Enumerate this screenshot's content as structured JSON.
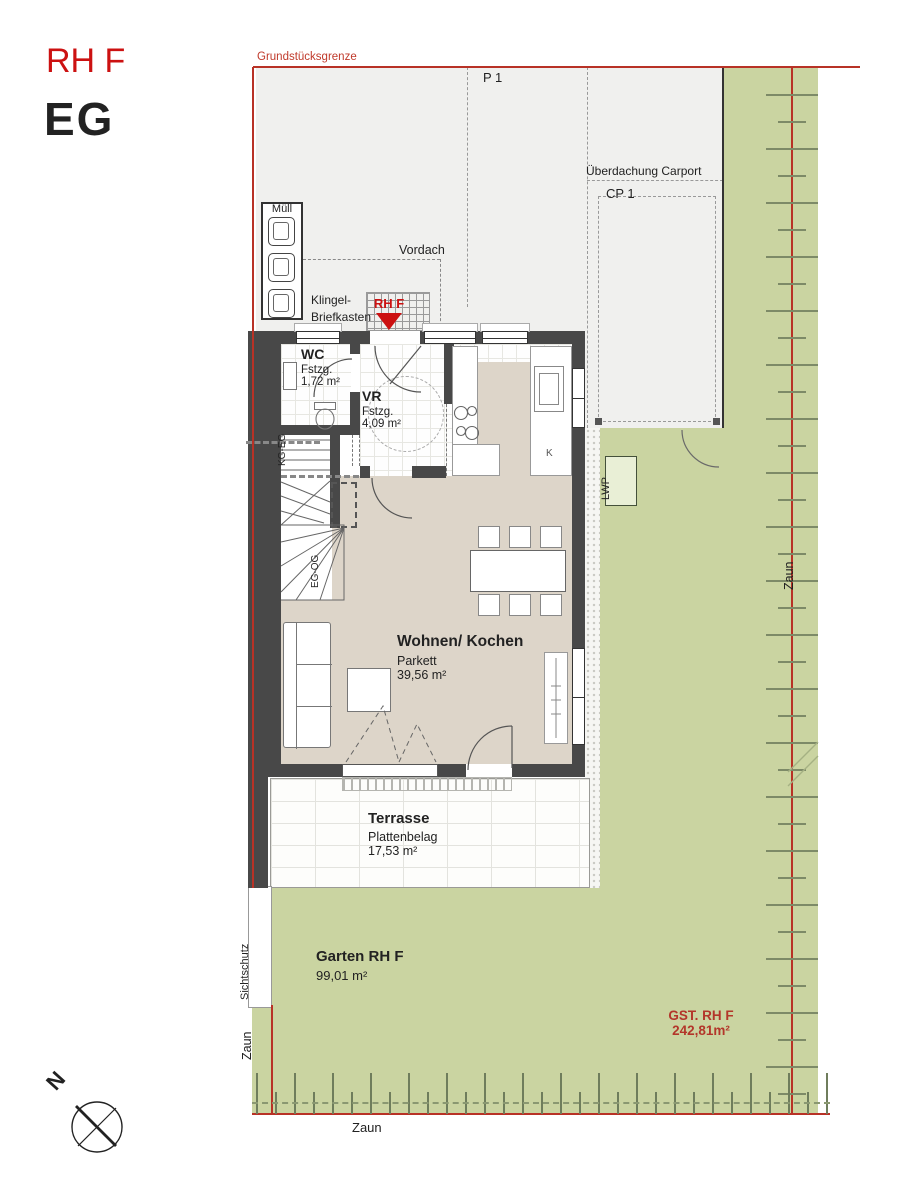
{
  "header": {
    "project_code": "RH F",
    "floor_label": "EG"
  },
  "site": {
    "boundary_label": "Grundstücksgrenze",
    "parking_space": "P 1",
    "carport_roof": "Überdachung Carport",
    "carport_space": "CP 1",
    "waste_label": "Müll",
    "canopy_label": "Vordach",
    "doorbell_line1": "Klingel-",
    "doorbell_line2": "Briefkasten",
    "entrance_marker": "RH F",
    "heatpump_label": "LWP",
    "privacy_screen": "Sichtschutz",
    "fence_label_left": "Zaun",
    "fence_label_right": "Zaun",
    "fence_label_bottom": "Zaun",
    "garden_name": "Garten RH F",
    "garden_area": "99,01 m²",
    "plot_name": "GST. RH F",
    "plot_area": "242,81m²",
    "compass_north": "N"
  },
  "rooms": {
    "wc": {
      "name": "WC",
      "finish": "Fstzg.",
      "area": "1,72 m²"
    },
    "vr": {
      "name": "VR",
      "finish": "Fstzg.",
      "area": "4,09 m²"
    },
    "living": {
      "name": "Wohnen/ Kochen",
      "finish": "Parkett",
      "area": "39,56 m²"
    },
    "terrace": {
      "name": "Terrasse",
      "finish": "Plattenbelag",
      "area": "17,53 m²"
    },
    "stairs_lower": "KG-EG",
    "stairs_upper": "EG-OG",
    "kitchen_marker": "K"
  },
  "colors": {
    "boundary_red": "#b83226",
    "accent_red": "#cc1111",
    "lawn_green": "#cad4a1",
    "parquet_beige": "#ddd5c9",
    "wall_gray": "#484848"
  }
}
